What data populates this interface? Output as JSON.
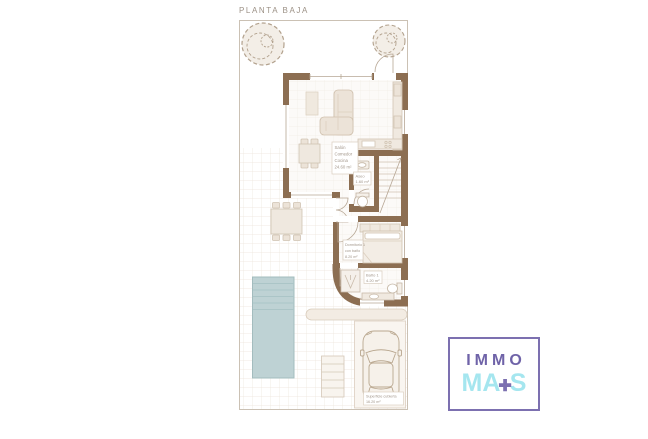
{
  "title": "PLANTA BAJA",
  "plan": {
    "labels": {
      "living": [
        "Salón",
        "Comedor",
        "Cocina",
        "24.60 m²"
      ],
      "aseo": [
        "Aseo",
        "1.60 m²"
      ],
      "bedroom": [
        "Dormitorio 1",
        "con baño",
        "8.20 m²"
      ],
      "bathroom": [
        "Baño 1",
        "4.20 m²"
      ],
      "parking": [
        "Superficie cubierta",
        "16.20 m²"
      ]
    },
    "colors": {
      "wall": "#8c6e52",
      "pool": "#bed2d4",
      "furniture": "#ece3d8",
      "plot_border": "#cbc1b4"
    }
  },
  "logo": {
    "line1": "IMMO",
    "line2_left": "MA",
    "plus": "✚",
    "line2_right": "S",
    "colors": {
      "purple": "#6f63a8",
      "cyan": "#a5e6ef",
      "border": "#7c70b0"
    }
  }
}
